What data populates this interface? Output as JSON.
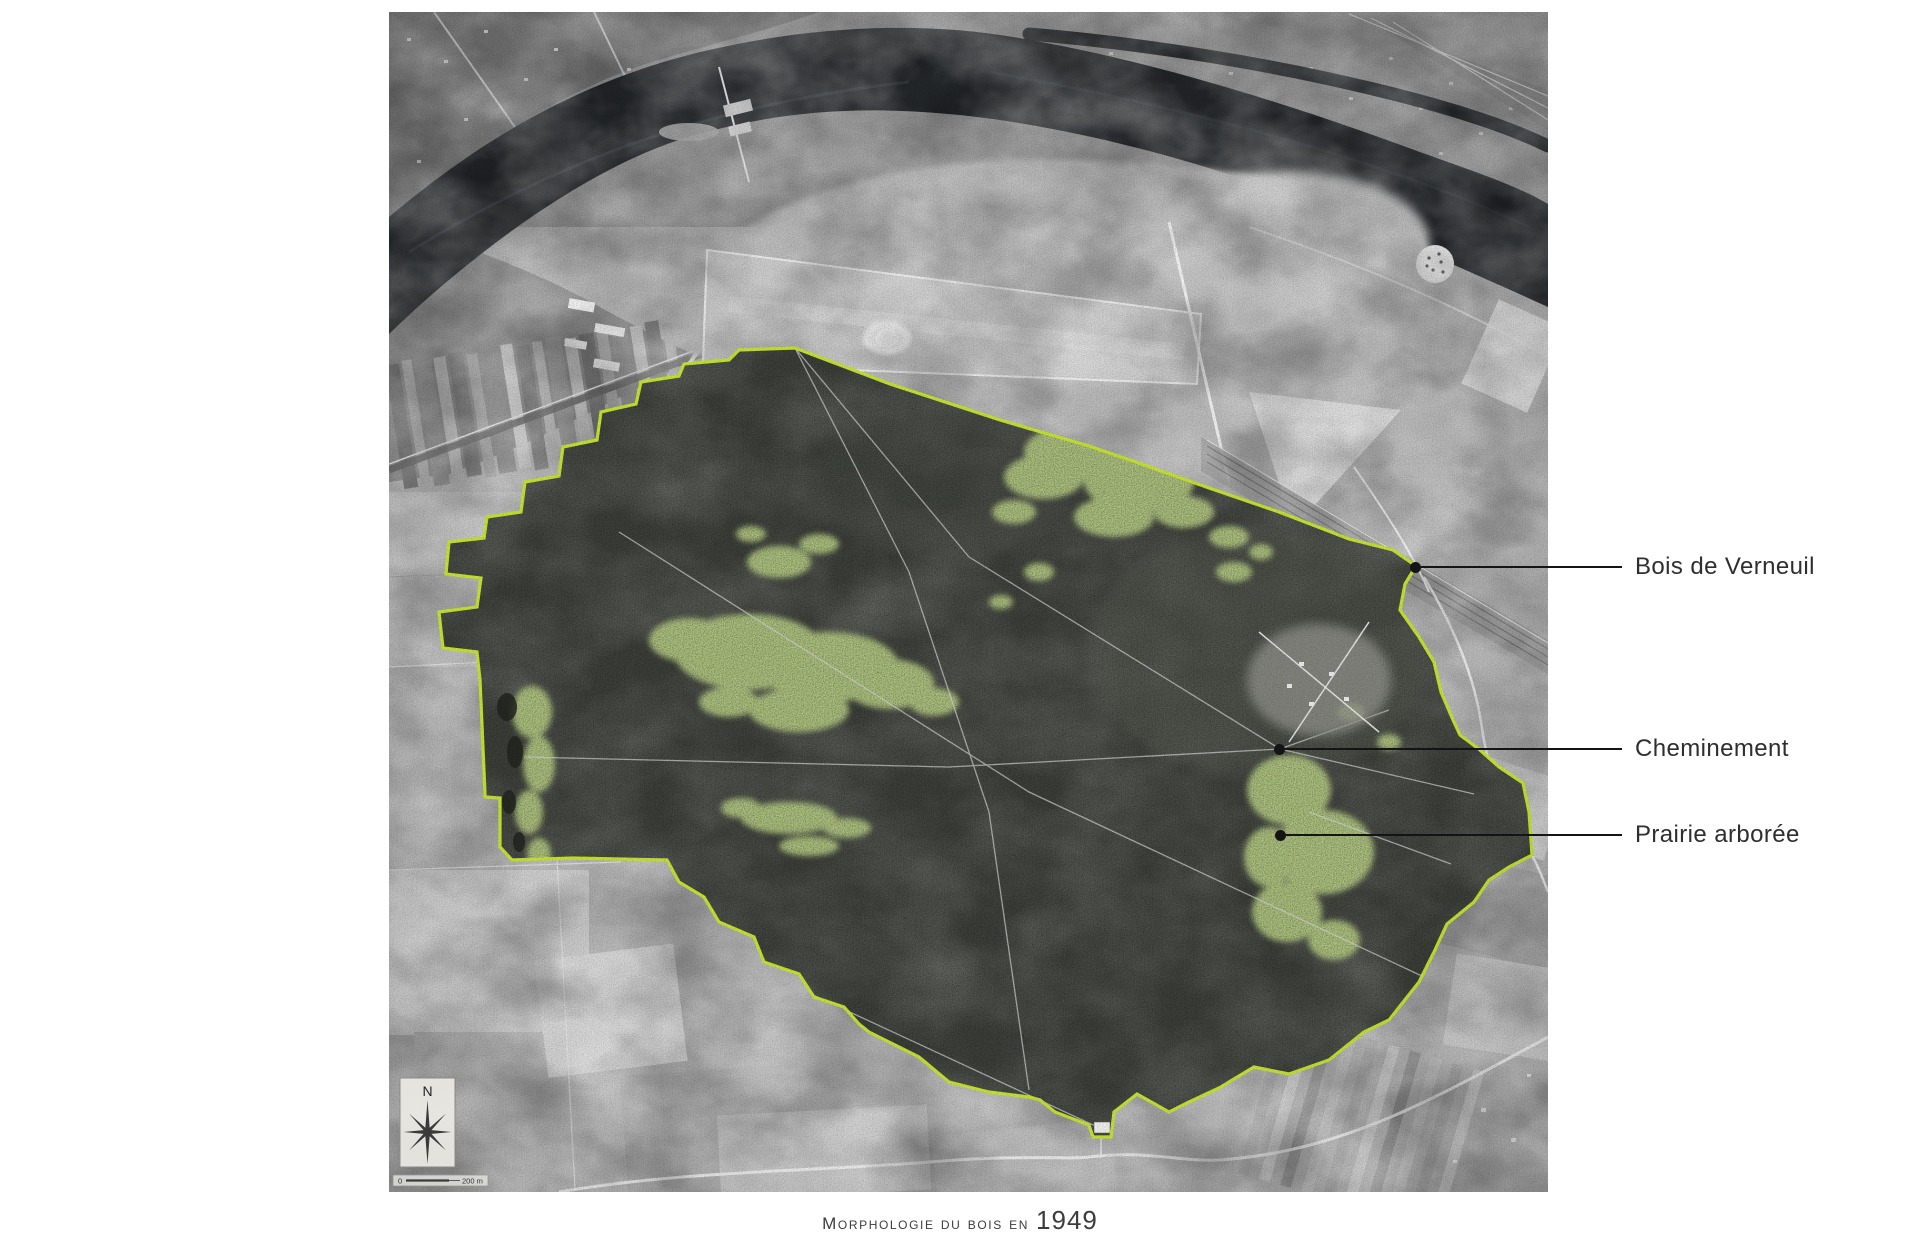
{
  "caption": {
    "prefix": "Morphologie du bois en",
    "year": "1949"
  },
  "annotations": [
    {
      "label": "Bois de Verneuil"
    },
    {
      "label": "Cheminement"
    },
    {
      "label": "Prairie arborée"
    }
  ],
  "compass": {
    "north_label": "N"
  },
  "scale_bar": {
    "start_label": "0",
    "end_label": "200 m"
  },
  "colors": {
    "page_background": "#ffffff",
    "forest_outline": "#c8e533",
    "prairie_highlight": "#b9cf87",
    "annotation_ink": "#141414",
    "caption_ink": "#3c3c3c",
    "river_water": "#24272a",
    "forest_canopy": "#3f423c"
  }
}
